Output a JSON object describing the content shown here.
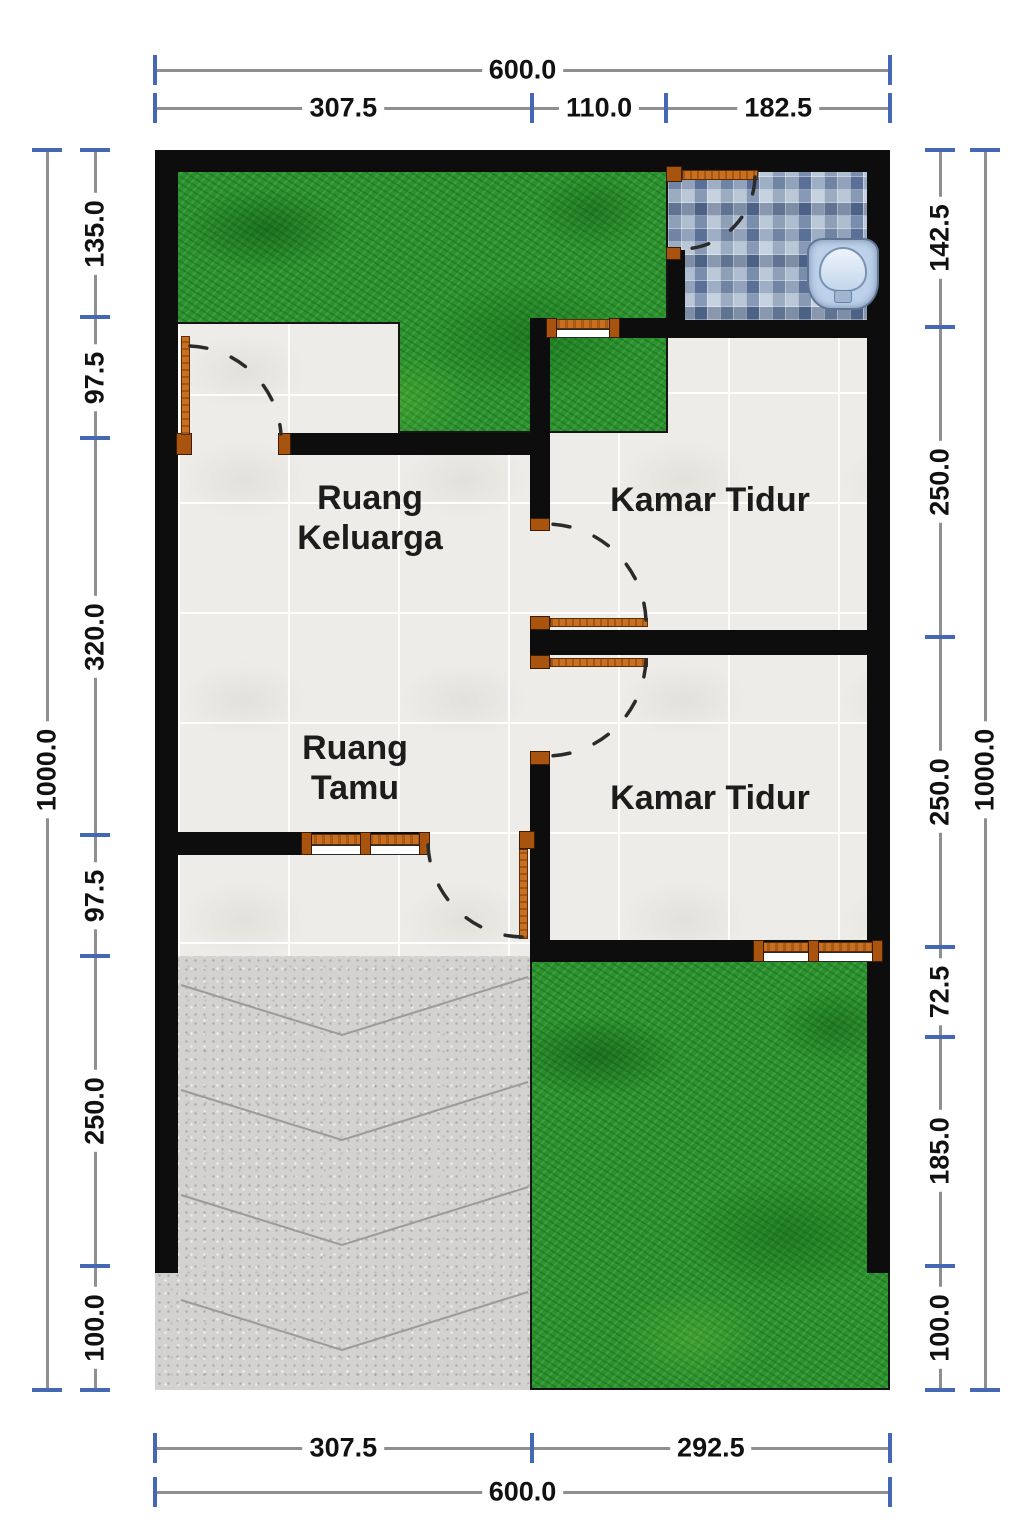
{
  "page": {
    "background": "#ffffff"
  },
  "rooms": [
    {
      "id": "ruang-keluarga",
      "label": "Ruang Keluarga"
    },
    {
      "id": "kamar-tidur-1",
      "label": "Kamar Tidur"
    },
    {
      "id": "ruang-tamu",
      "label": "Ruang Tamu"
    },
    {
      "id": "kamar-tidur-2",
      "label": "Kamar Tidur"
    }
  ],
  "dimensions": {
    "top_outer": [
      "600.0"
    ],
    "top_inner": [
      "307.5",
      "110.0",
      "182.5"
    ],
    "bottom_inner": [
      "307.5",
      "292.5"
    ],
    "bottom_outer": [
      "600.0"
    ],
    "left_outer": [
      "1000.0"
    ],
    "left_inner": [
      "135.0",
      "97.5",
      "320.0",
      "97.5",
      "250.0",
      "100.0"
    ],
    "right_inner": [
      "142.5",
      "250.0",
      "250.0",
      "72.5",
      "185.0",
      "100.0"
    ],
    "right_outer": [
      "1000.0"
    ]
  },
  "icons": {
    "toilet": "squat-toilet-icon"
  },
  "colors": {
    "wall": "#0d0d0d",
    "tile_floor": "#edece8",
    "grass": "#2c9231",
    "concrete": "#d3d2d0",
    "bathroom_tile": "#93a3ba",
    "wood_door": "#c96f1f",
    "wood_frame": "#a8540f",
    "dim_line": "#8f8f8f",
    "dim_tick": "#4468b4",
    "label_text": "#1c1c1c",
    "toilet": "#bdd2ea"
  }
}
